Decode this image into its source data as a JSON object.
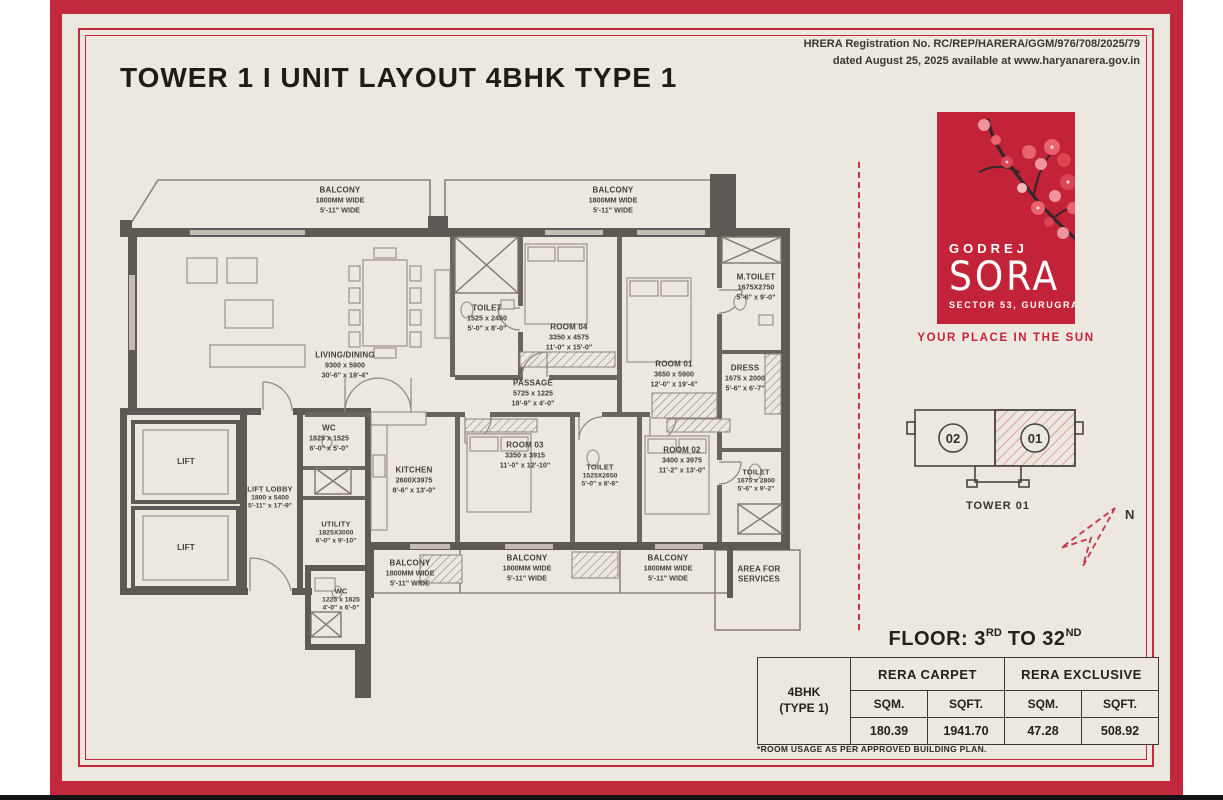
{
  "header": {
    "title": "TOWER 1 I UNIT LAYOUT 4BHK TYPE 1",
    "hrera_line1": "HRERA Registration No. RC/REP/HARERA/GGM/976/708/2025/79",
    "hrera_line2": "dated August 25, 2025 available at www.haryanarera.gov.in"
  },
  "brand": {
    "logo_brand": "GODREJ",
    "logo_name": "SORA",
    "logo_location": "SECTOR 53, GURUGRAM",
    "tagline": "YOUR PLACE IN THE SUN",
    "brand_red": "#c32339"
  },
  "keyplan": {
    "unit_left": "02",
    "unit_right": "01",
    "tower_label": "TOWER 01",
    "north_label": "N"
  },
  "plan": {
    "rooms": [
      {
        "name": "BALCONY",
        "metric": "1800MM WIDE",
        "imperial": "5'-11\" WIDE"
      },
      {
        "name": "BALCONY",
        "metric": "1800MM WIDE",
        "imperial": "5'-11\" WIDE"
      },
      {
        "name": "LIVING/DINING",
        "metric": "9300 x 5900",
        "imperial": "30'-6\" x 19'-4\""
      },
      {
        "name": "TOILET",
        "metric": "1525 x 2450",
        "imperial": "5'-0\" x 8'-0\""
      },
      {
        "name": "ROOM 04",
        "metric": "3350 x 4575",
        "imperial": "11'-0\" x 15'-0\""
      },
      {
        "name": "ROOM 01",
        "metric": "3650 x 5900",
        "imperial": "12'-0\" x 19'-4\""
      },
      {
        "name": "M.TOILET",
        "metric": "1675X2750",
        "imperial": "5'-6\" x 9'-0\""
      },
      {
        "name": "DRESS",
        "metric": "1675 x 2000",
        "imperial": "5'-6\" x 6'-7\""
      },
      {
        "name": "PASSAGE",
        "metric": "5725 x 1225",
        "imperial": "18'-9\" x 4'-0\""
      },
      {
        "name": "WC",
        "metric": "1825 x 1525",
        "imperial": "6'-0\" x 5'-0\""
      },
      {
        "name": "LIFT"
      },
      {
        "name": "LIFT"
      },
      {
        "name": "LIFT LOBBY",
        "metric": "1800 x 5400",
        "imperial": "5'-11\" x 17'-9\""
      },
      {
        "name": "UTILITY",
        "metric": "1825X3000",
        "imperial": "6'-0\" x 9'-10\""
      },
      {
        "name": "WC",
        "metric": "1225 x 1825",
        "imperial": "4'-0\" x 6'-0\""
      },
      {
        "name": "KITCHEN",
        "metric": "2600X3975",
        "imperial": "8'-6\" x 13'-0\""
      },
      {
        "name": "ROOM 03",
        "metric": "3350 x 3915",
        "imperial": "11'-0\" x 12'-10\""
      },
      {
        "name": "TOILET",
        "metric": "1525X2650",
        "imperial": "5'-0\" x 8'-8\""
      },
      {
        "name": "ROOM 02",
        "metric": "3400 x 3975",
        "imperial": "11'-2\" x 13'-0\""
      },
      {
        "name": "TOILET",
        "metric": "1675 x 2800",
        "imperial": "5'-6\" x 9'-2\""
      },
      {
        "name": "BALCONY",
        "metric": "1800MM WIDE",
        "imperial": "5'-11\" WIDE"
      },
      {
        "name": "BALCONY",
        "metric": "1800MM WIDE",
        "imperial": "5'-11\" WIDE"
      },
      {
        "name": "BALCONY",
        "metric": "1800MM WIDE",
        "imperial": "5'-11\" WIDE"
      },
      {
        "name": "AREA FOR SERVICES"
      }
    ]
  },
  "floor_info": {
    "prefix": "FLOOR: 3",
    "sup1": "RD",
    "mid": " TO 32",
    "sup2": "ND"
  },
  "area_table": {
    "unit_line1": "4BHK",
    "unit_line2": "(TYPE 1)",
    "group1": "RERA CARPET",
    "group2": "RERA EXCLUSIVE",
    "col1": "SQM.",
    "col2": "SQFT.",
    "col3": "SQM.",
    "col4": "SQFT.",
    "val1": "180.39",
    "val2": "1941.70",
    "val3": "47.28",
    "val4": "508.92",
    "footnote": "*ROOM USAGE AS PER APPROVED BUILDING PLAN."
  }
}
